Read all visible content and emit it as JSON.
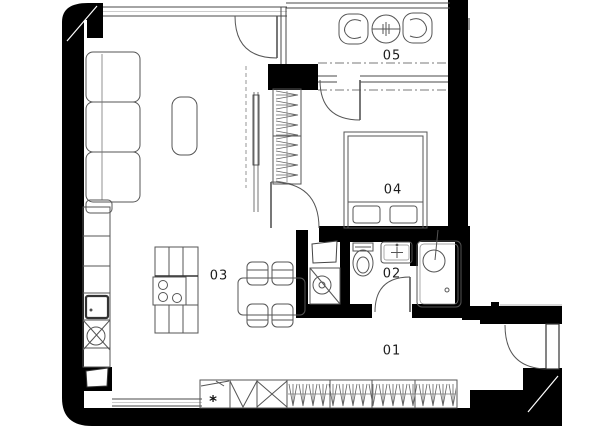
{
  "plan": {
    "room_labels": {
      "r01": "01",
      "r02": "02",
      "r03": "03",
      "r04": "04",
      "r05": "05"
    },
    "closet_symbol": "*",
    "colors": {
      "wall": "#000000",
      "furniture_line": "#5a5a5a",
      "background": "#ffffff"
    }
  }
}
